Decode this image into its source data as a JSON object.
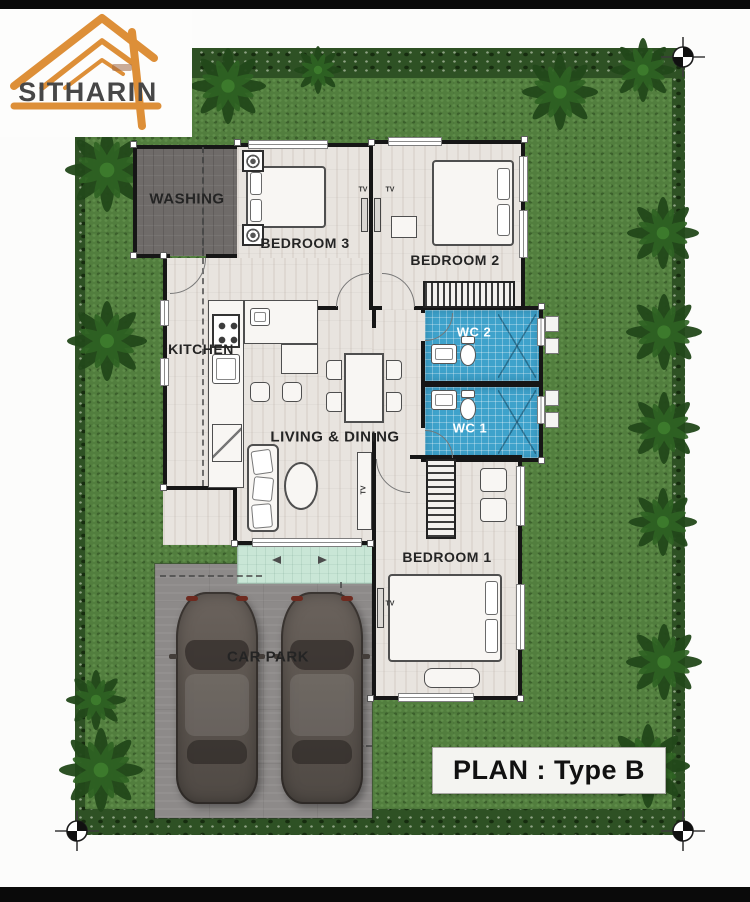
{
  "logo": {
    "brand": "SITHARIN"
  },
  "badge": {
    "text": "PLAN : Type B"
  },
  "rooms": {
    "washing": "WASHING",
    "bedroom3": "BEDROOM 3",
    "bedroom2": "BEDROOM 2",
    "kitchen": "KITCHEN",
    "living": "LIVING & DINING",
    "wc2": "WC 2",
    "wc1": "WC 1",
    "bedroom1": "BEDROOM 1",
    "carpark": "CAR PARK"
  },
  "labels": {
    "tv": "TV"
  },
  "colors": {
    "grass": "#527e3e",
    "hedge": "#2e5124",
    "floor": "#e8e4df",
    "washing_floor": "#6f6b69",
    "carpark_floor": "#8d8a89",
    "wc_tile": "#3ea2cb",
    "terrace": "#c9e6d6",
    "wall": "#161616",
    "logo_orange": "#dd8f38",
    "logo_text": "#474747",
    "car_body": "#5d5650",
    "letterbox": "#0a0a0a"
  }
}
